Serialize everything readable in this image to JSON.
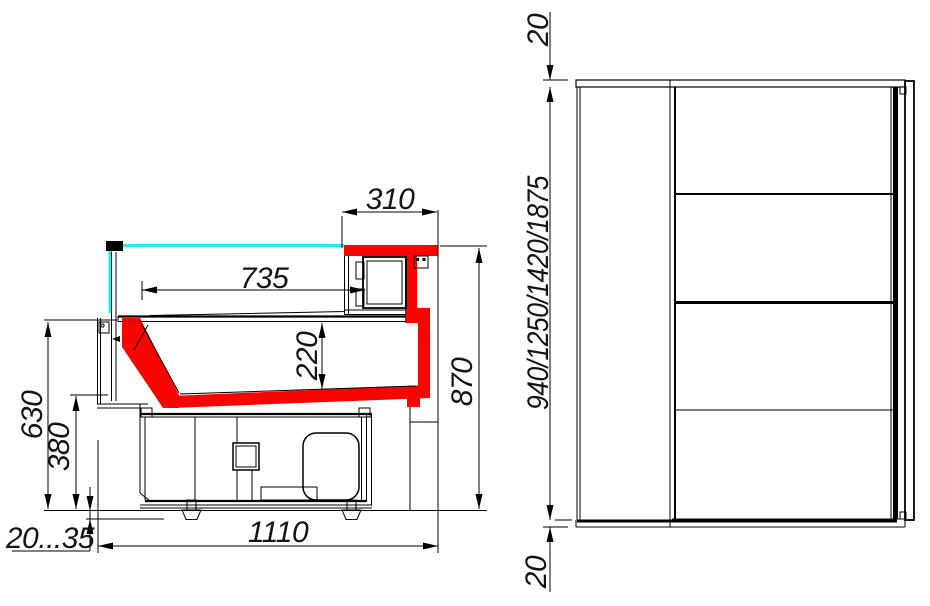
{
  "drawing": {
    "title": "Refrigerated serve-over counter technical drawing",
    "colors": {
      "highlight_red": "#fa0400",
      "glass_cyan": "#1ef0f0",
      "line_black": "#000000",
      "background": "#ffffff"
    },
    "section_view": {
      "name": "cross-section view",
      "dims": {
        "rear_top_depth": "310",
        "display_depth": "735",
        "well_depth": "220",
        "counter_height": "630",
        "well_bottom_height": "380",
        "overall_height": "870",
        "base_depth": "1110",
        "foot_adjust_range": "20...35"
      }
    },
    "front_view": {
      "name": "end elevation view",
      "dims": {
        "top_panel_thickness": "20",
        "height_options": "940/1250/1420/1875",
        "bottom_panel_thickness": "20"
      }
    }
  }
}
